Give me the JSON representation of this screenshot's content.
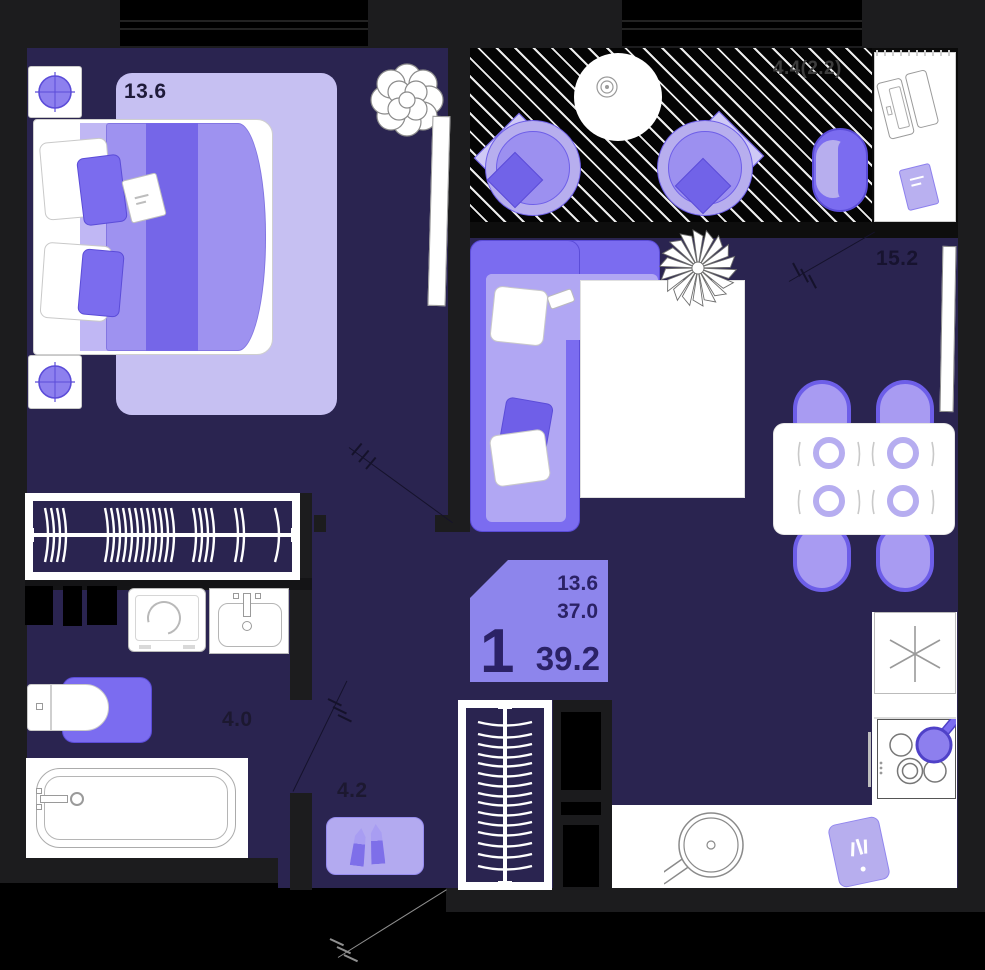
{
  "plan": {
    "title": "1-room apartment floor plan",
    "badge": {
      "rooms_count": "1",
      "living_area": "13.6",
      "area_without_balcony": "37.0",
      "total_area": "39.2"
    },
    "rooms": {
      "bedroom": {
        "label": "13.6"
      },
      "living_room": {
        "label": "15.2"
      },
      "bathroom": {
        "label": "4.0"
      },
      "hallway": {
        "label": "4.2"
      },
      "balcony": {
        "label": "4.4(2.2)"
      }
    },
    "colors": {
      "floor": "#2a2450",
      "wall": "#1c1c1e",
      "accent": "#7b6cf0",
      "accentDeep": "#5b4cd8",
      "lavender": "#b7aeee",
      "lavenderLight": "#c6c0f2",
      "badgeBg": "#8d85ec",
      "badgeText": "#2b2266",
      "labelDark": "#1b1734",
      "balconyLabel": "#3d3d3d"
    }
  }
}
